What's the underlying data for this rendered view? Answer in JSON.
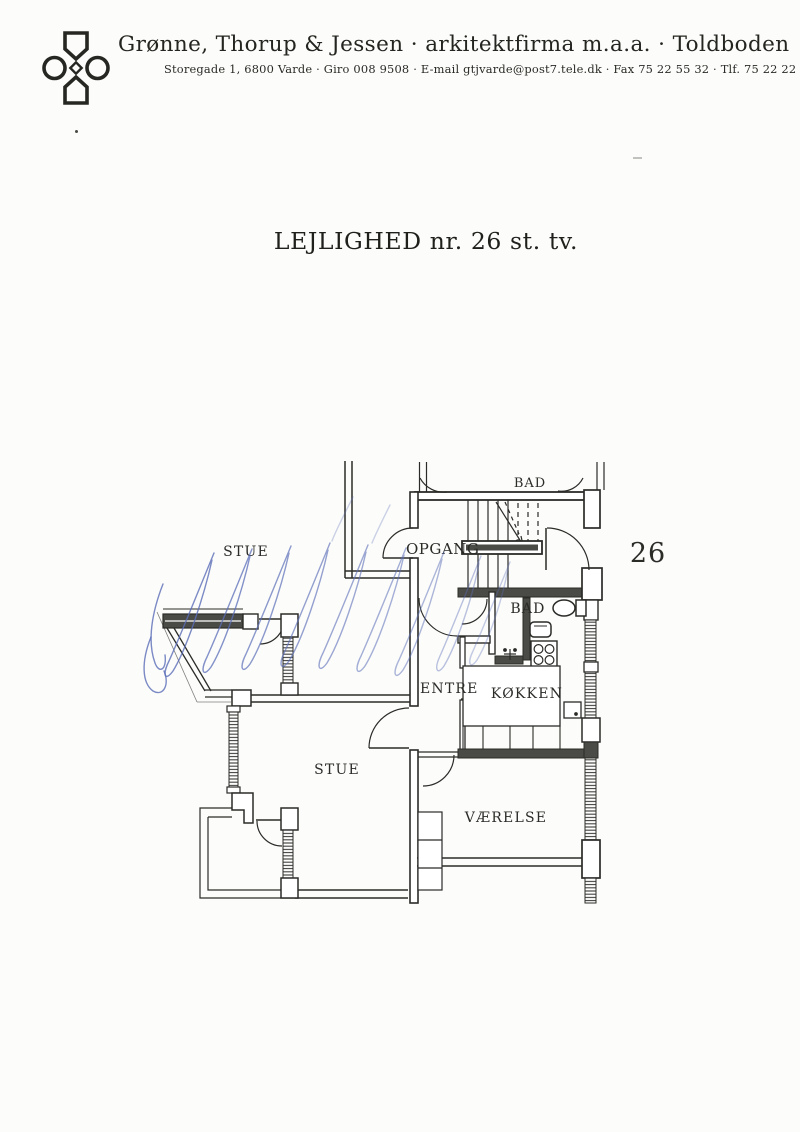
{
  "letterhead": {
    "company_name": "Grønne, Thorup & Jessen · arkitektfirma m.a.a. · Toldboden",
    "address_line": "Storegade 1, 6800 Varde · Giro 008 9508 · E-mail gtjvarde@post7.tele.dk · Fax 75 22 55 32 · Tlf. 75 22 22 33"
  },
  "document": {
    "title": "LEJLIGHED nr. 26 st. tv."
  },
  "floor_plan": {
    "apartment_number": "26",
    "labels": {
      "neighbor_living_room": "STUE",
      "stairwell": "OPGANG",
      "bath_upper": "BAD",
      "bath": "BAD",
      "hall": "ENTRE",
      "kitchen": "KØKKEN",
      "living_room": "STUE",
      "room": "VÆRELSE"
    },
    "colors": {
      "ink": "#2b2b28",
      "pen_annotation": "#5a6db8",
      "paper": "#fcfcfa"
    }
  }
}
